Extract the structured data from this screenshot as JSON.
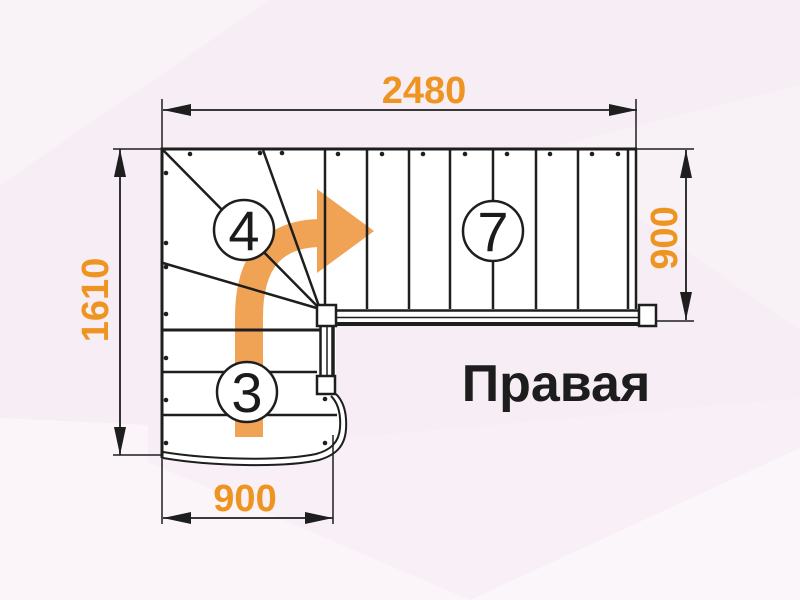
{
  "drawing": {
    "orientation_label": "Правая",
    "dimensions": {
      "total_length_mm": "2480",
      "total_width_mm": "1610",
      "upper_flight_width_mm": "900",
      "lower_flight_width_mm": "900"
    },
    "steps": {
      "winder_count": "4",
      "upper_flight_count": "7",
      "lower_flight_count": "3"
    },
    "icons": {
      "direction_arrow": "curved-right-arrow-icon"
    },
    "colors": {
      "dimension_text": "#EE9421",
      "direction_arrow": "#F0A355",
      "linework": "#1E1E1E",
      "background": "#F7EDF4"
    }
  }
}
